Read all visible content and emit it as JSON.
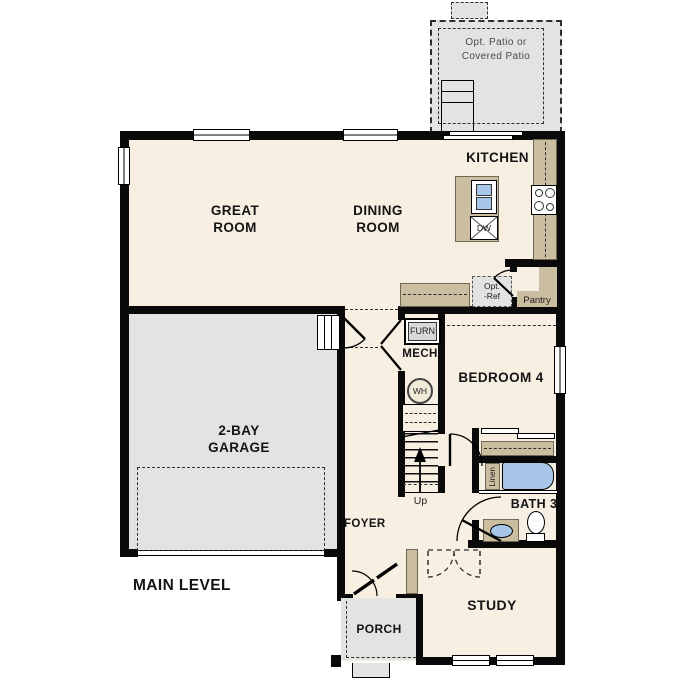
{
  "plan": {
    "title": "MAIN LEVEL",
    "rooms": {
      "great_room": {
        "line1": "GREAT",
        "line2": "ROOM"
      },
      "dining_room": {
        "line1": "DINING",
        "line2": "ROOM"
      },
      "kitchen": {
        "label": "KITCHEN"
      },
      "garage": {
        "line1": "2-BAY",
        "line2": "GARAGE"
      },
      "bedroom4": {
        "label": "BEDROOM 4"
      },
      "bath3": {
        "label": "BATH 3"
      },
      "study": {
        "label": "STUDY"
      },
      "porch": {
        "label": "PORCH"
      },
      "foyer": {
        "label": "FOYER"
      },
      "mech": {
        "label": "MECH"
      },
      "pantry": {
        "label": "Pantry"
      },
      "patio": {
        "line1": "Opt. Patio or",
        "line2": "Covered Patio"
      }
    },
    "fixtures": {
      "furnace": "FURN",
      "water_heater": "WH",
      "dishwasher": "DW",
      "linen": "Linen",
      "opt_ref": {
        "line1": "Opt.",
        "line2": "-Ref"
      },
      "stairs_up": "Up"
    },
    "palette": {
      "wall": "#0a0a0a",
      "floor": "#f7efe2",
      "garage_floor": "#e3e3e1",
      "cabinet_tan": "#cbbd9f",
      "fixture_blue": "#a7c6e8"
    }
  }
}
